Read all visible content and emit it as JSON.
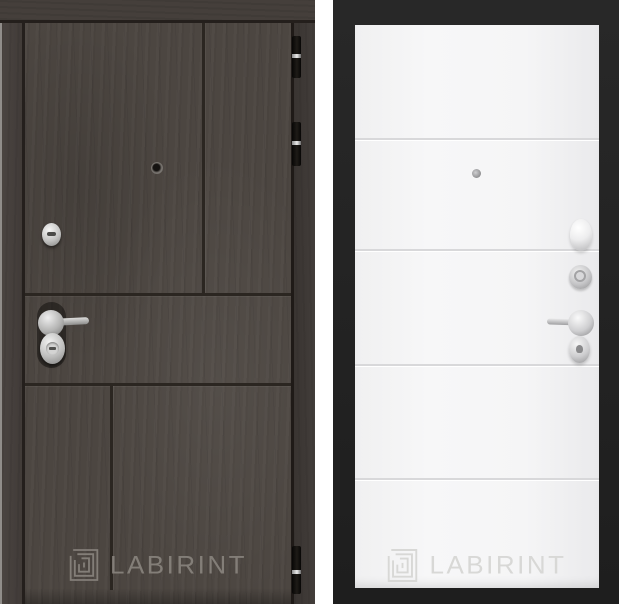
{
  "brand": {
    "name": "LABIRINT"
  },
  "left_door": {
    "label": "LABIRINT",
    "style": "dark-woodgrain-exterior-panel",
    "finish_hex": "#4c4641",
    "groove_hex": "#2b2621",
    "hardware": [
      "peephole",
      "lock-cylinder",
      "lever-handle",
      "keyhole-escutcheon",
      "hinge-top",
      "hinge-upper",
      "hinge-bottom"
    ]
  },
  "right_door": {
    "label": "LABIRINT",
    "style": "white-interior-panel-13",
    "finish_hex": "#f5f5f6",
    "backdrop_hex": "#232323",
    "groove_hex": "#d8d8da",
    "hardware": [
      "peephole",
      "thumbturn-knob",
      "lock-cylinder",
      "lever-handle",
      "keyhole-escutcheon"
    ]
  }
}
